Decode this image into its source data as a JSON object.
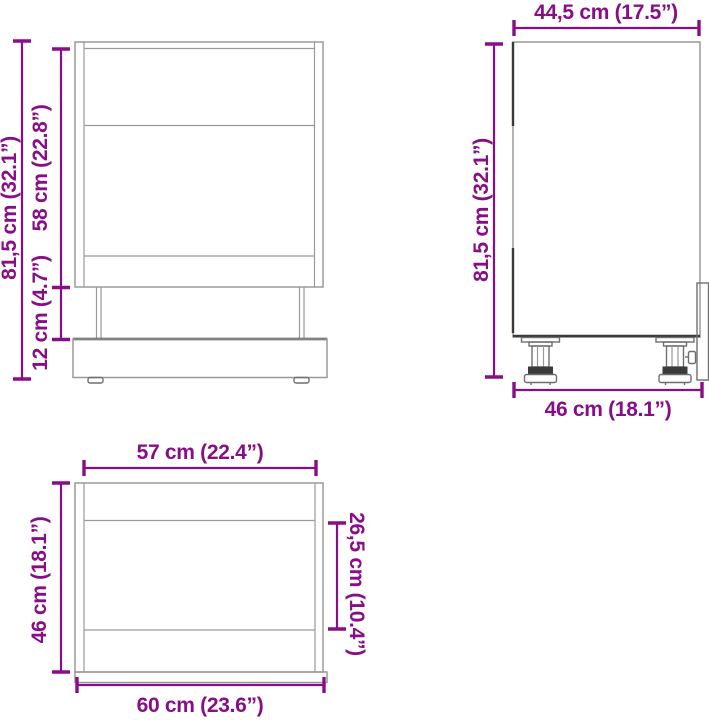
{
  "colors": {
    "accent": "#880e88",
    "line-light": "#9a9a9a",
    "line-mid": "#6f6f6f",
    "line-dark": "#3a3a3a",
    "background": "#ffffff"
  },
  "views": {
    "front": {
      "dims": {
        "total_height": "81,5 cm (32.1”)",
        "body_height": "58 cm (22.8”)",
        "plinth_height": "12 cm (4.7”)"
      }
    },
    "side": {
      "dims": {
        "top_depth": "44,5 cm (17.5”)",
        "height": "81,5 cm (32.1”)",
        "bottom_depth": "46 cm (18.1”)"
      }
    },
    "top": {
      "dims": {
        "inner_width": "57 cm (22.4”)",
        "depth": "46 cm (18.1”)",
        "inner_depth": "26,5 cm (10.4”)",
        "outer_width": "60 cm (23.6”)"
      }
    }
  }
}
